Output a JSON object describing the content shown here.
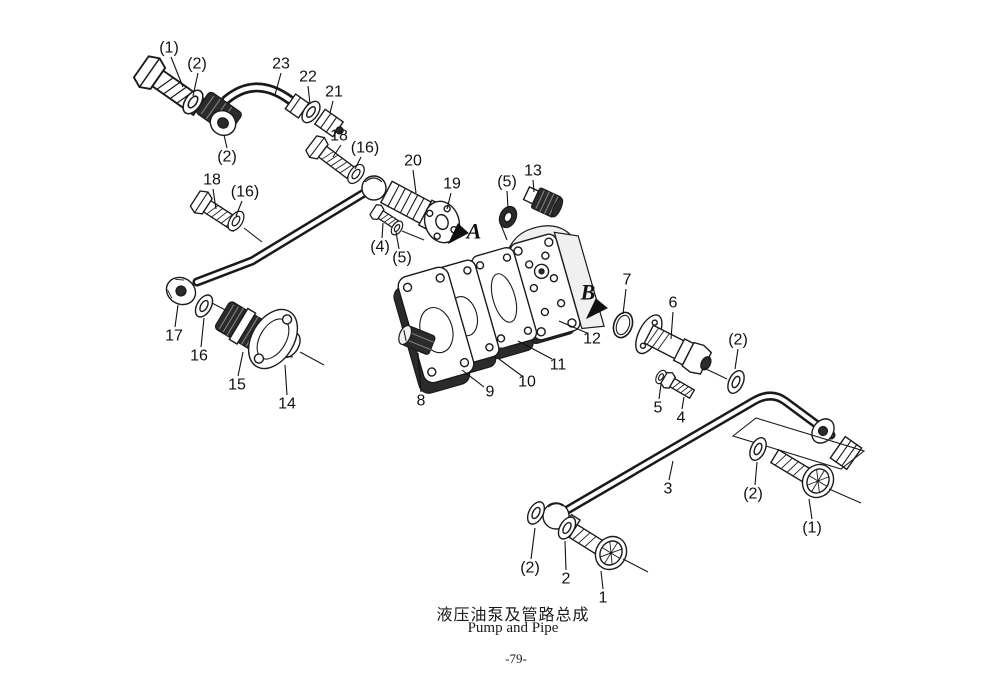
{
  "diagram": {
    "title_cn": "液压油泵及管路总成",
    "title_en": "Pump and Pipe",
    "page_number": "-79-",
    "colors": {
      "line": "#1a1a1a",
      "paper": "#ffffff"
    },
    "callouts": [
      {
        "label": "(1)",
        "x": 169,
        "y": 48,
        "leader": [
          171,
          57,
          183,
          87
        ]
      },
      {
        "label": "(2)",
        "x": 197,
        "y": 64,
        "leader": [
          198,
          73,
          193,
          96
        ]
      },
      {
        "label": "23",
        "x": 281,
        "y": 64,
        "leader": [
          281,
          73,
          275,
          95
        ]
      },
      {
        "label": "22",
        "x": 308,
        "y": 77,
        "leader": [
          308,
          86,
          310,
          104
        ]
      },
      {
        "label": "21",
        "x": 334,
        "y": 92,
        "leader": [
          333,
          101,
          330,
          113
        ]
      },
      {
        "label": "18",
        "x": 339,
        "y": 136,
        "leader": [
          341,
          145,
          333,
          157
        ]
      },
      {
        "label": "(16)",
        "x": 365,
        "y": 148,
        "leader": [
          361,
          157,
          355,
          169
        ]
      },
      {
        "label": "(2)",
        "x": 227,
        "y": 157,
        "leader": [
          227,
          148,
          224,
          135
        ]
      },
      {
        "label": "18",
        "x": 212,
        "y": 180,
        "leader": [
          213,
          189,
          216,
          209
        ]
      },
      {
        "label": "(16)",
        "x": 245,
        "y": 192,
        "leader": [
          242,
          201,
          236,
          216
        ]
      },
      {
        "label": "20",
        "x": 413,
        "y": 161,
        "leader": [
          413,
          170,
          416,
          193
        ]
      },
      {
        "label": "19",
        "x": 452,
        "y": 184,
        "leader": [
          451,
          193,
          447,
          209
        ]
      },
      {
        "label": "(4)",
        "x": 380,
        "y": 247,
        "leader": [
          382,
          238,
          383,
          223
        ]
      },
      {
        "label": "(5)",
        "x": 402,
        "y": 258,
        "leader": [
          399,
          249,
          396,
          232
        ]
      },
      {
        "label": "(5)",
        "x": 507,
        "y": 182,
        "leader": [
          507,
          191,
          508,
          208
        ]
      },
      {
        "label": "13",
        "x": 533,
        "y": 171,
        "leader": [
          533,
          180,
          534,
          192
        ]
      },
      {
        "label": "8",
        "x": 421,
        "y": 401,
        "leader": [
          421,
          392,
          418,
          353
        ]
      },
      {
        "label": "9",
        "x": 490,
        "y": 392,
        "leader": [
          484,
          387,
          462,
          370
        ]
      },
      {
        "label": "10",
        "x": 527,
        "y": 382,
        "leader": [
          522,
          376,
          499,
          359
        ]
      },
      {
        "label": "11",
        "x": 558,
        "y": 365,
        "leader": [
          552,
          359,
          518,
          341
        ]
      },
      {
        "label": "12",
        "x": 592,
        "y": 339,
        "leader": [
          587,
          333,
          559,
          321
        ]
      },
      {
        "label": "7",
        "x": 627,
        "y": 280,
        "leader": [
          626,
          289,
          623,
          314
        ]
      },
      {
        "label": "6",
        "x": 673,
        "y": 303,
        "leader": [
          673,
          312,
          671,
          339
        ]
      },
      {
        "label": "(2)",
        "x": 738,
        "y": 340,
        "leader": [
          738,
          349,
          735,
          369
        ]
      },
      {
        "label": "5",
        "x": 658,
        "y": 408,
        "leader": [
          659,
          399,
          661,
          384
        ]
      },
      {
        "label": "4",
        "x": 681,
        "y": 418,
        "leader": [
          682,
          409,
          684,
          397
        ]
      },
      {
        "label": "3",
        "x": 668,
        "y": 489,
        "leader": [
          669,
          480,
          673,
          461
        ]
      },
      {
        "label": "(2)",
        "x": 753,
        "y": 494,
        "leader": [
          755,
          485,
          757,
          462
        ]
      },
      {
        "label": "(1)",
        "x": 812,
        "y": 528,
        "leader": [
          812,
          519,
          809,
          499
        ]
      },
      {
        "label": "(2)",
        "x": 530,
        "y": 568,
        "leader": [
          531,
          559,
          535,
          528
        ]
      },
      {
        "label": "2",
        "x": 566,
        "y": 579,
        "leader": [
          566,
          570,
          565,
          541
        ]
      },
      {
        "label": "1",
        "x": 603,
        "y": 598,
        "leader": [
          603,
          589,
          601,
          571
        ]
      },
      {
        "label": "17",
        "x": 174,
        "y": 336,
        "leader": [
          175,
          327,
          178,
          305
        ]
      },
      {
        "label": "16",
        "x": 199,
        "y": 356,
        "leader": [
          201,
          347,
          204,
          318
        ]
      },
      {
        "label": "15",
        "x": 237,
        "y": 385,
        "leader": [
          238,
          376,
          243,
          352
        ]
      },
      {
        "label": "14",
        "x": 287,
        "y": 404,
        "leader": [
          287,
          395,
          285,
          365
        ]
      }
    ],
    "view_labels": [
      {
        "label": "A",
        "x": 474,
        "y": 231,
        "arrow": "449,243 458,224 468,233"
      },
      {
        "label": "B",
        "x": 588,
        "y": 292,
        "arrow": "587,318 596,299 607,308"
      }
    ]
  }
}
